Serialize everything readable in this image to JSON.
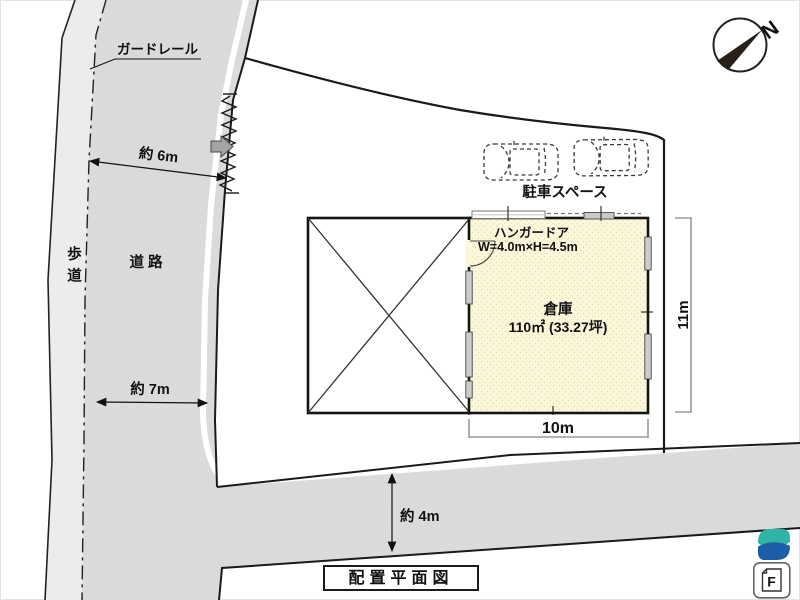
{
  "plan": {
    "title": "配置平面図",
    "north_label": "N"
  },
  "roads": {
    "sidewalk_label": "歩道",
    "road_label": "道 路",
    "guardrail_label": "ガードレール",
    "width_upper": "約 6m",
    "width_lower": "約 7m",
    "south_road_width": "約 4m"
  },
  "site": {
    "parking_label": "駐車スペース",
    "warehouse_name": "倉庫",
    "warehouse_area": "110㎡ (33.27坪)",
    "hangar_door_label": "ハンガードア",
    "hangar_door_size": "W=4.0m×H=4.5m",
    "width_dim": "10m",
    "depth_dim": "11m"
  },
  "branding": {
    "doc_icon_letter": "F"
  },
  "colors": {
    "road": "#d9dbdd",
    "sidewalk": "#ececee",
    "warehouse_fill": "#fbf7da",
    "line": "#1a1a1a",
    "dimension_gray": "#9a9a9a",
    "logo_teal": "#2fb3a4",
    "logo_blue": "#1c5fa8"
  }
}
